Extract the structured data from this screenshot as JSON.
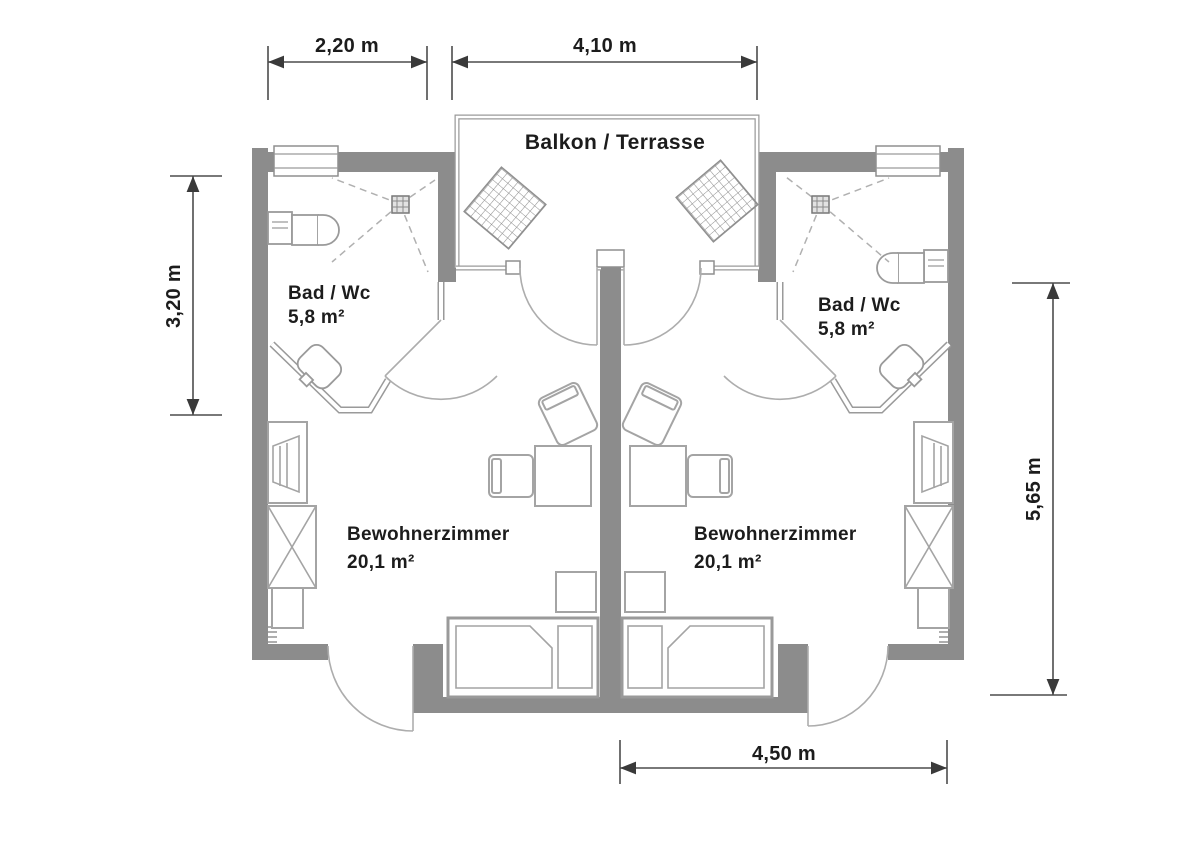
{
  "plan": {
    "balcony_label": "Balkon / Terrasse",
    "bath_left": {
      "name": "Bad / Wc",
      "area": "5,8 m²"
    },
    "bath_right": {
      "name": "Bad / Wc",
      "area": "5,8 m²"
    },
    "room_left": {
      "name": "Bewohnerzimmer",
      "area": "20,1 m²"
    },
    "room_right": {
      "name": "Bewohnerzimmer",
      "area": "20,1 m²"
    },
    "dimensions": {
      "bath_width": "2,20 m",
      "balcony_width": "4,10 m",
      "bath_depth": "3,20 m",
      "room_depth": "5,65 m",
      "room_width": "4,50 m"
    },
    "colors": {
      "wall": "#8c8c8c",
      "partition": "#9a9a9a",
      "furniture": "#a4a4a4",
      "dimension": "#4d4d4d",
      "text": "#1c1c1c",
      "background": "#ffffff"
    }
  }
}
